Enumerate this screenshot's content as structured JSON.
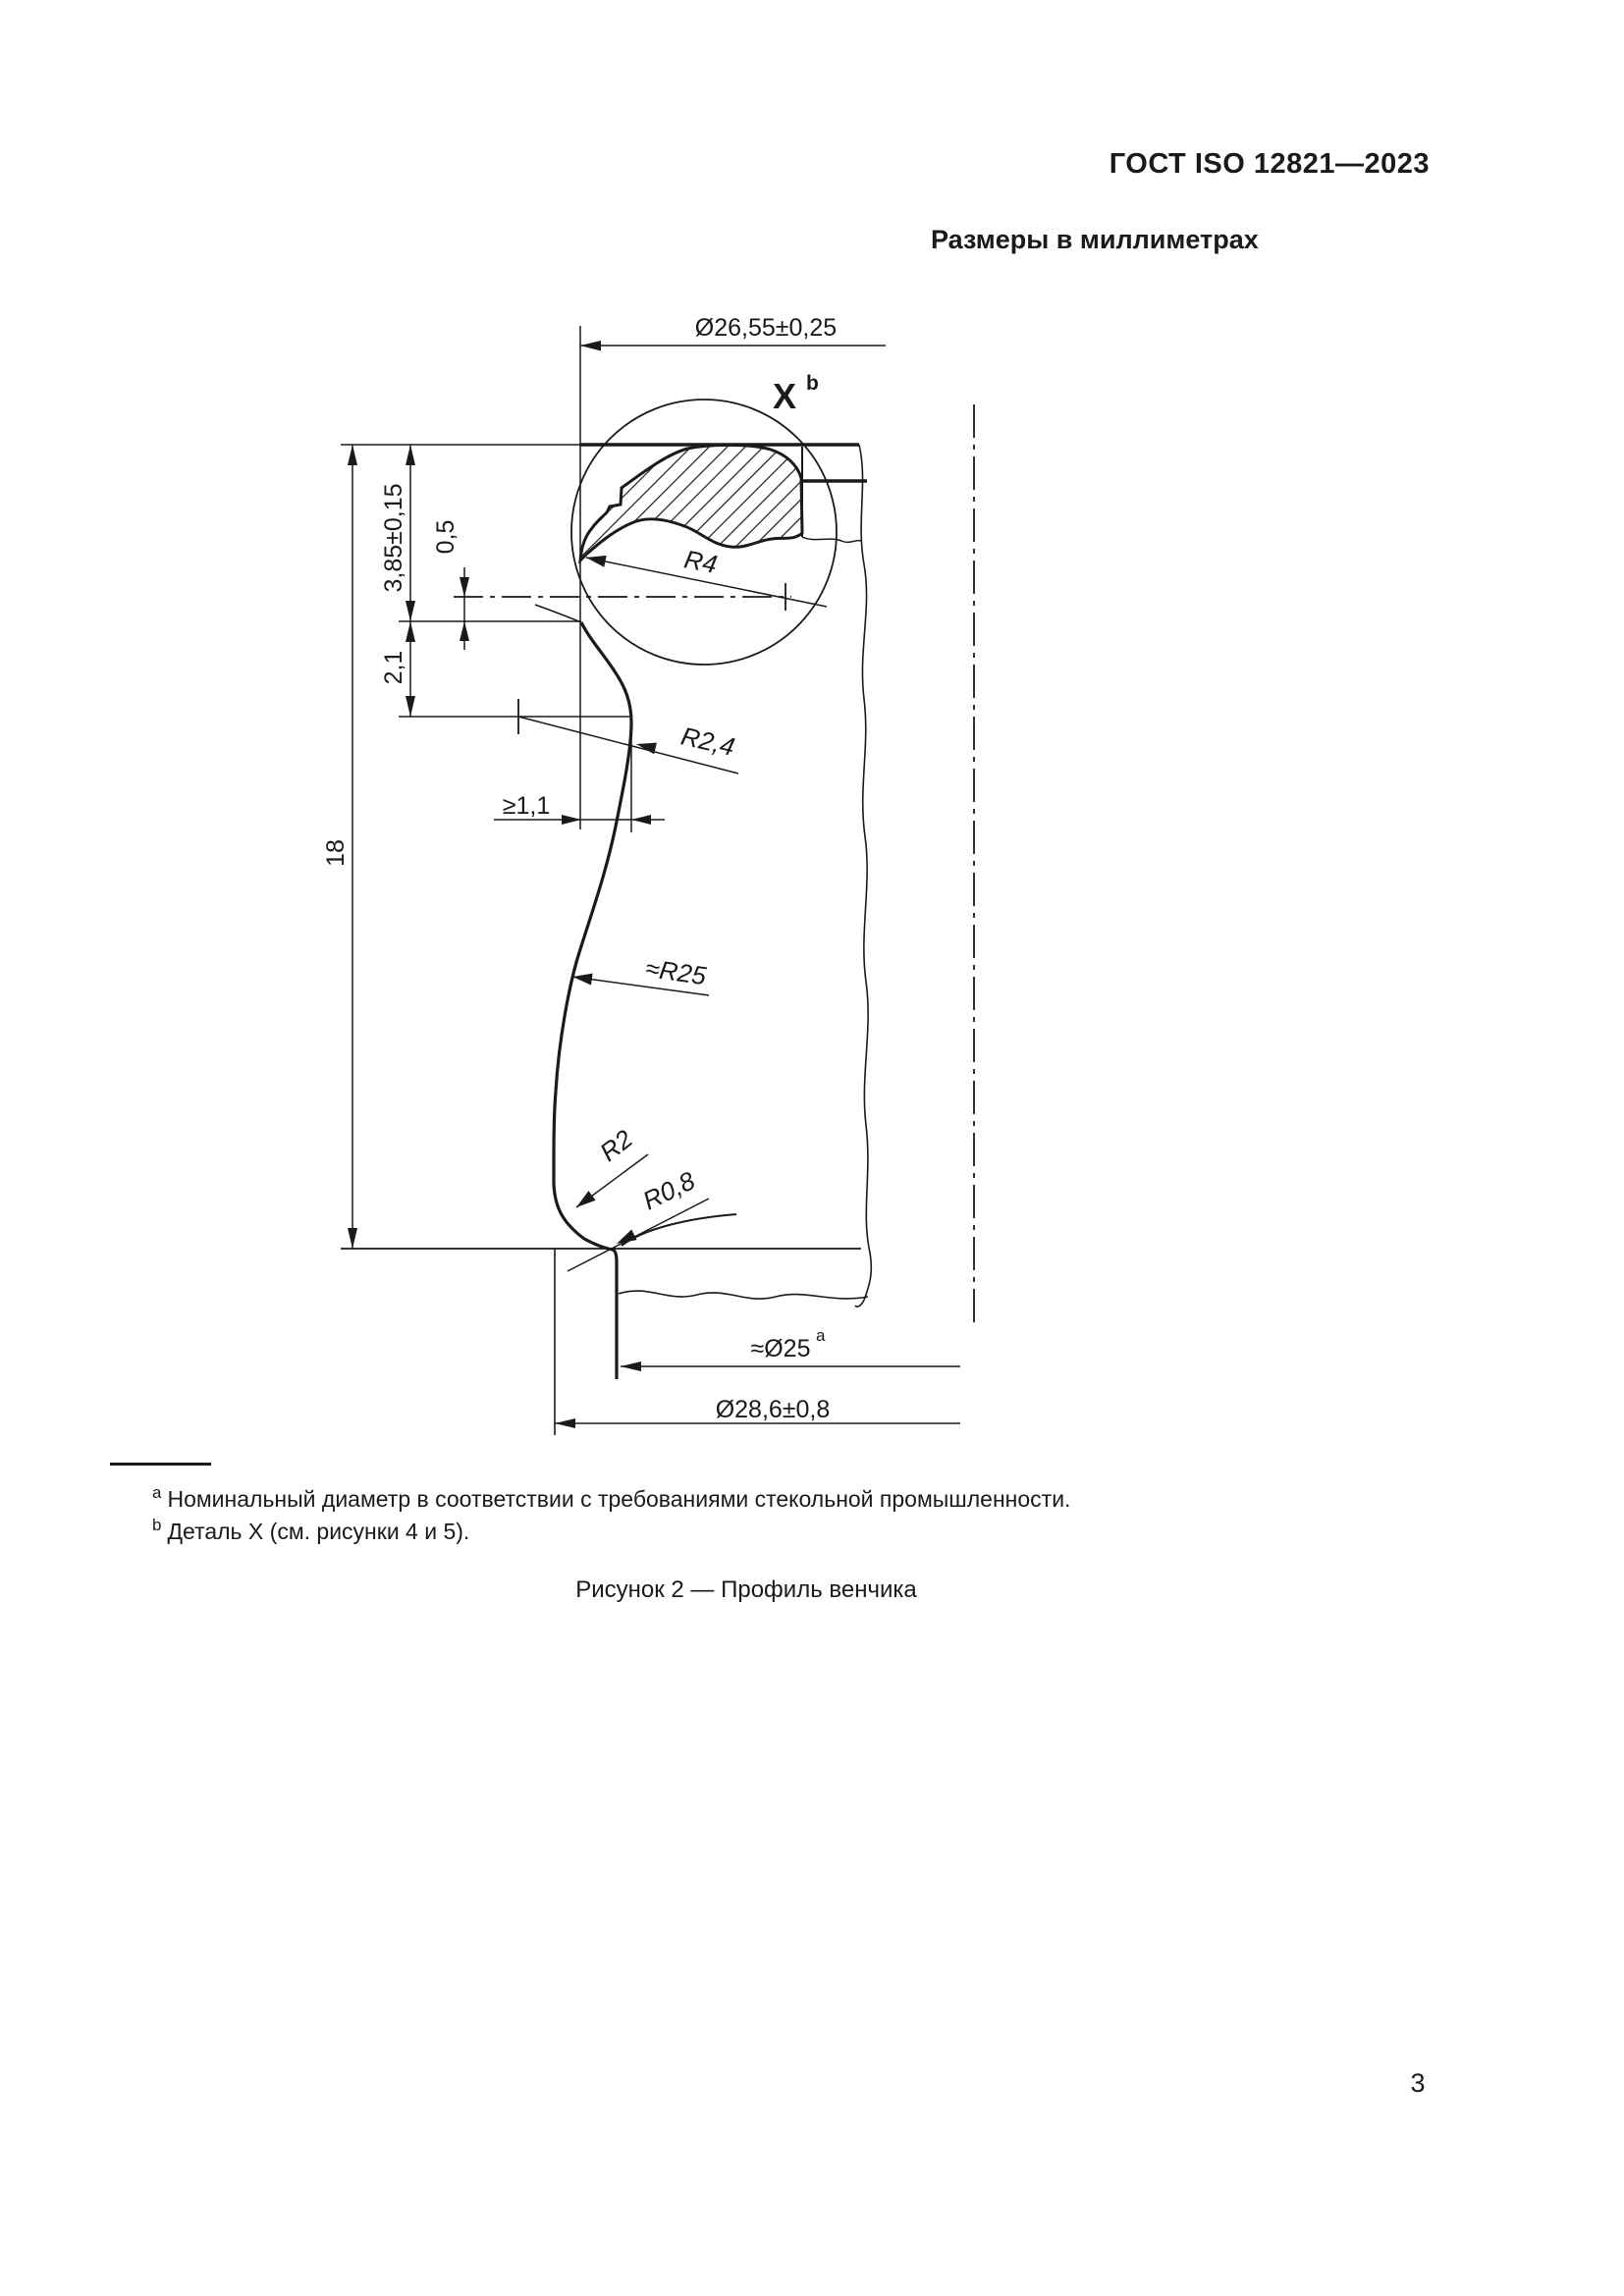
{
  "page": {
    "header": "ГОСТ ISO 12821—2023",
    "units_note": "Размеры в миллиметрах",
    "caption": "Рисунок 2 — Профиль венчика",
    "page_number": "3"
  },
  "footnotes": [
    {
      "marker": "a",
      "text": "Номинальный диаметр в соответствии с требованиями стекольной промышленности."
    },
    {
      "marker": "b",
      "text": "Деталь X (см. рисунки 4 и 5)."
    }
  ],
  "drawing": {
    "detail_label": "X",
    "detail_label_sup": "b",
    "ink_color": "#1a1a1a",
    "dims": {
      "top_diameter": "Ø26,55±0,25",
      "bead_height": "3,85±0,15",
      "axis_offset": "0,5",
      "undercut_height": "2,1",
      "finish_height": "18",
      "bead_radius": "R4",
      "undercut_radius": "R2,4",
      "min_wall": "≥1,1",
      "neck_radius": "≈R25",
      "collar_radius": "R2",
      "fillet_radius": "R0,8",
      "neck_diameter": "≈Ø25",
      "neck_diameter_sup": "a",
      "collar_diameter": "Ø28,6±0,8"
    }
  }
}
